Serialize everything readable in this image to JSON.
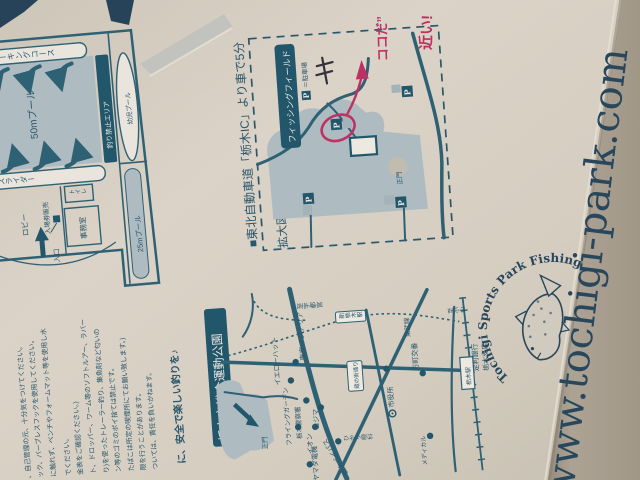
{
  "colors": {
    "print_teal": "#30657a",
    "print_dark_navy": "#235a70",
    "pool_fill": "#b5c4ca",
    "paper": "#ded7cb",
    "pen_red": "#c43467",
    "pen_black": "#34343c",
    "url_navy": "#2a4a60"
  },
  "pool_map": {
    "course_top": "ウォーキングコース",
    "pool_50m": "50mプール",
    "no_fishing_area": "釣り禁止エリア",
    "kids_pool": "幼児プール",
    "slider": "スライダー",
    "pool_25m": "25mプール",
    "toilet": "トイレ",
    "office": "事務室",
    "ticket_machine": "入場券販売",
    "lobby": "ロビー",
    "entrance": "入口"
  },
  "access_map": {
    "heading": "■東北自動車道「栃木IC」より車で5分",
    "title": "拡大図",
    "field_label": "フィッシングフィールド",
    "parking_p": "P",
    "parking_legend": "＝駐車場",
    "main_gate": "正門",
    "note_here": "ココだ”",
    "note_close": "近い!"
  },
  "road_map": {
    "park_banner": "栃木市総合運動公園",
    "main_gate": "正門",
    "to_utsunomiya": "至宇都宮",
    "to_oyama": "至小山",
    "tobu_line": "東武線",
    "shin_tochigi_station": "新栃木駅",
    "tochigi_station": "栃木駅",
    "kuranomachi_street": "蔵の街通り",
    "bypass": "栃木バイパス",
    "pois": [
      {
        "label": "東京インテリア"
      },
      {
        "label": "イエローハット"
      },
      {
        "label": "万町交番"
      },
      {
        "label": "足利銀行"
      },
      {
        "label": "栃木支店"
      },
      {
        "label": "市役所"
      },
      {
        "label": "コジマ"
      },
      {
        "label": "フライングガーデン"
      },
      {
        "label": "栃木警察署"
      },
      {
        "label": "イオン"
      },
      {
        "label": "ヤマダ電機"
      },
      {
        "label": "ひかり眼科"
      },
      {
        "label": "メディカル"
      }
    ]
  },
  "rules": {
    "lines": [
      "、自己管理の元、十分気をつけてください。",
      "ック、バーブレスフックを使用してください。",
      "に触れず、ベンチやフォームマット等を使用し水",
      "でください。",
      "金表をご確認ください。)",
      "ト、ドロッパー、ワーム等のソフトルアー、ラバー",
      "り)を使ったトレーラー釣り、集魚剤など匂いの",
      "ン等のゴミのポイ捨ては禁止です。",
      "たばこは所定の喫煙所にてお願い致します。)",
      "限を行うことがあります。",
      "ついては、責任を負いかねます。"
    ],
    "closing": "に、安全で楽しい釣りを♪"
  },
  "footer": {
    "url": "www.tochigi-park.com",
    "logo_text": "Tochigi Sports Park Fishing Field"
  }
}
